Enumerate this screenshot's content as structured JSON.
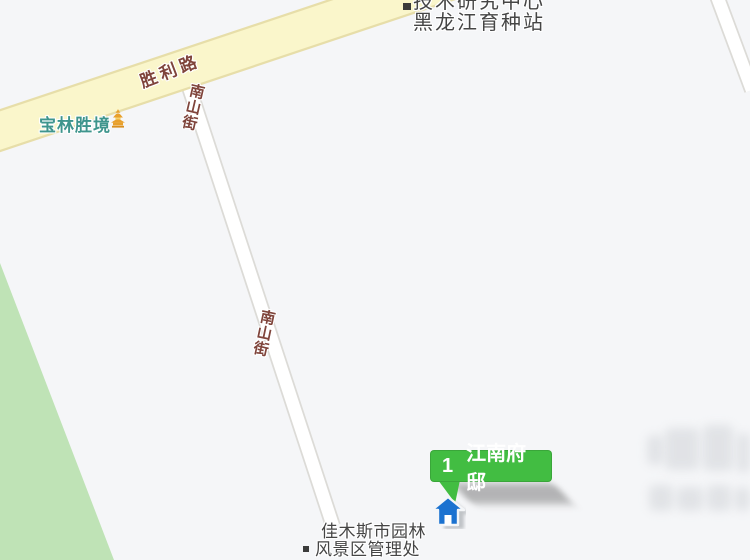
{
  "map": {
    "colors": {
      "background": "#F5F6F8",
      "park": "#BFE3B6",
      "road_major_fill": "#FAF6CB",
      "road_major_border": "#E7DEA9",
      "road_minor_fill": "#FFFFFF",
      "road_minor_border": "#DCDBD7",
      "road_label": "#7F443B",
      "scenic_label": "#3E958D",
      "poi_label": "#454545",
      "marker_bubble": "#42BD42",
      "marker_house": "#1B72D0"
    },
    "roads": {
      "major": {
        "name": "胜利路"
      },
      "minor": {
        "name": "南山街"
      }
    },
    "pois": {
      "research_center": {
        "line1": "技术研究中心",
        "line2": "黑龙江育种站"
      },
      "scenic": {
        "name": "宝林胜境"
      },
      "garden_admin": {
        "line1": "佳木斯市园林",
        "line2": "风景区管理处"
      }
    },
    "marker": {
      "index": "1",
      "name": "江南府邸"
    }
  }
}
